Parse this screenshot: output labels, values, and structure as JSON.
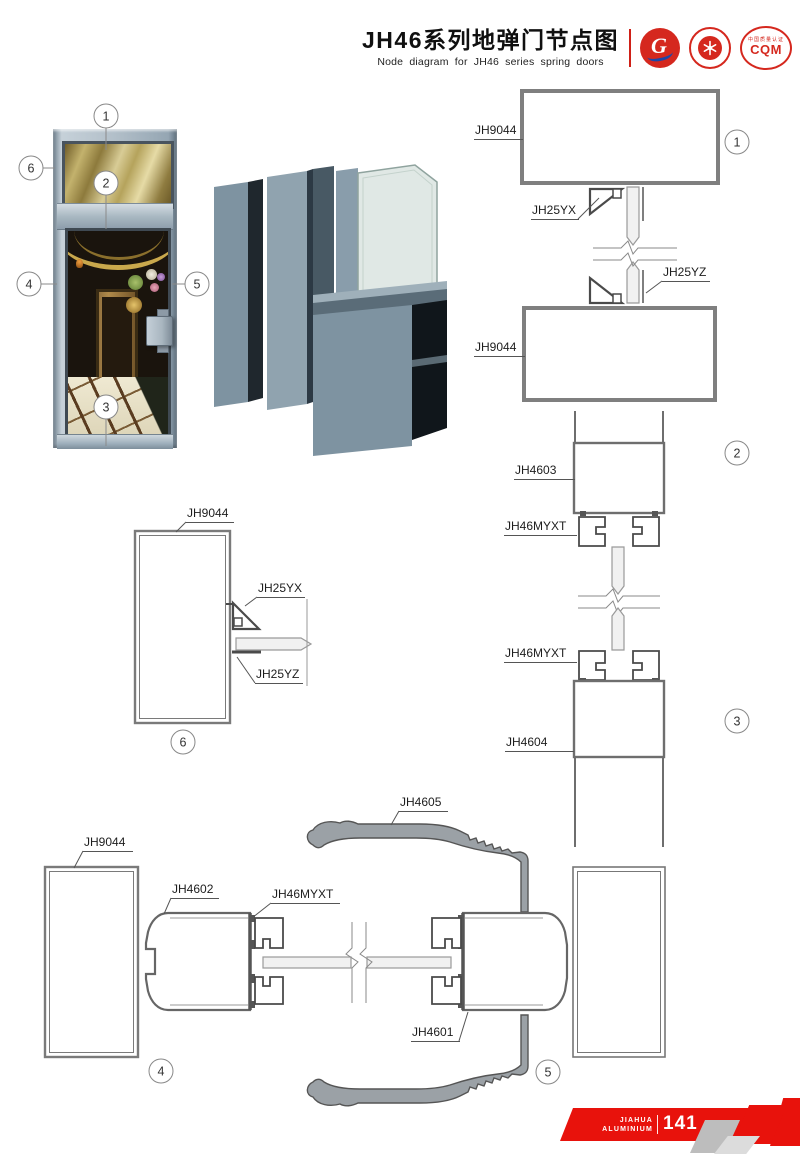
{
  "header": {
    "title_cn": "JH46系列地弹门节点图",
    "title_en": "Node diagram for JH46 series spring doors",
    "logos": {
      "logo1_text": "G",
      "logo3_text": "CQM",
      "logo3_top": "中国质量认证",
      "brand_red": "#d5281e"
    }
  },
  "callouts": {
    "c1": "1",
    "c2": "2",
    "c3": "3",
    "c4": "4",
    "c5": "5",
    "c6": "6"
  },
  "labels": {
    "d1_frame_top": "JH9044",
    "d1_clip_yx": "JH25YX",
    "d1_clip_yz": "JH25YZ",
    "d1_frame_bottom": "JH9044",
    "d2_frame": "JH4603",
    "d2_bead": "JH46MYXT",
    "d3_bead": "JH46MYXT",
    "d3_frame": "JH4604",
    "d6_frame": "JH9044",
    "d6_clip_yx": "JH25YX",
    "d6_clip_yz": "JH25YZ",
    "d4_frame": "JH9044",
    "d4_stile": "JH4602",
    "d4_bead": "JH46MYXT",
    "d5_cover": "JH4605",
    "d5_stile": "JH4601"
  },
  "footer": {
    "brand_line1": "JIAHUA",
    "brand_line2": "ALUMINIUM",
    "page_number": "141",
    "accent_red": "#e8120c"
  }
}
